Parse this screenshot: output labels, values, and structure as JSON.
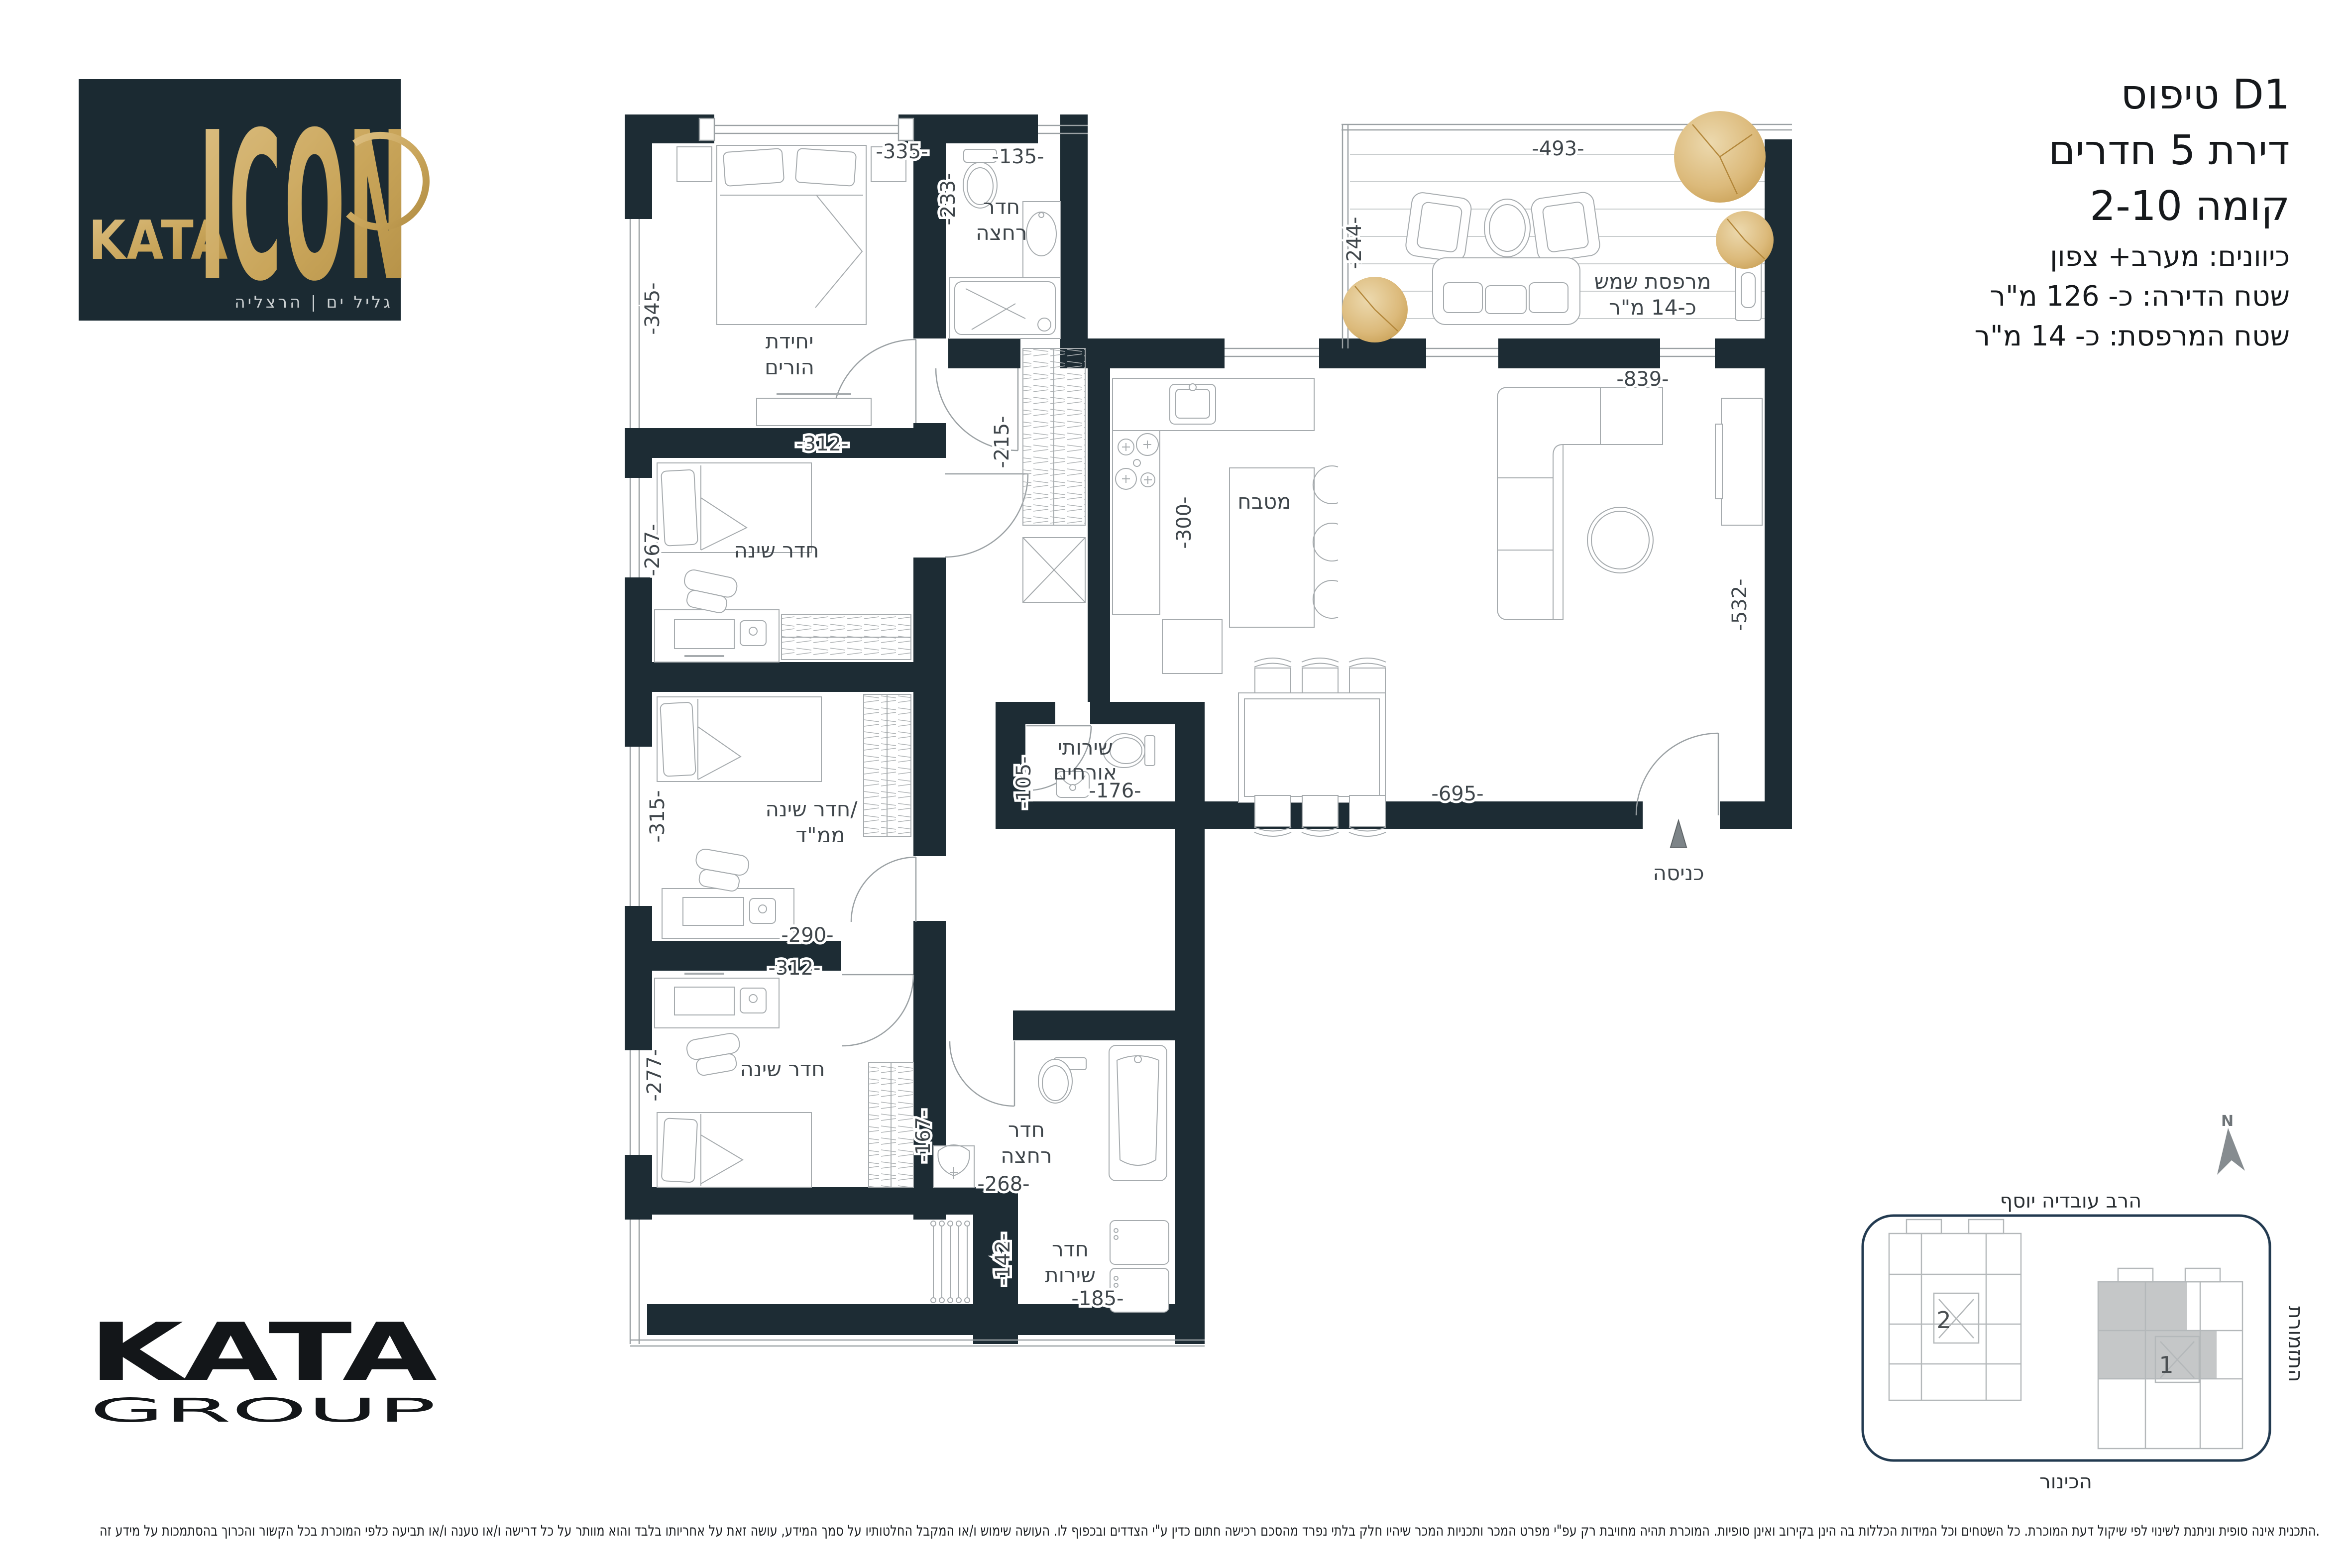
{
  "header": {
    "title_line1": "טיפוס D1",
    "title_line2": "דירת 5 חדרים",
    "title_line3": "קומה 2-10",
    "info_line1": "כיוונים: מערב+ צפון",
    "info_line2": "שטח הדירה: כ- 126 מ\"ר",
    "info_line3": "שטח המרפסת: כ- 14 מ\"ר"
  },
  "brand": {
    "kata": "KATA",
    "icon": "ICON",
    "tagline": "גליל ים | הרצליה",
    "group_name": "KATA",
    "group_sub": "GROUP"
  },
  "rooms": {
    "master_l1": "יחידת",
    "master_l2": "הורים",
    "bath_top_l1": "חדר",
    "bath_top_l2": "רחצה",
    "bedroom2": "חדר שינה",
    "mamad_l1": "חדר שינה/",
    "mamad_l2": "ממ\"ד",
    "bedroom3": "חדר שינה",
    "guest_wc_l1": "שירותי",
    "guest_wc_l2": "אורחים",
    "kitchen": "מטבח",
    "balcony_l1": "מרפסת שמש",
    "balcony_l2": "כ-14 מ\"ר",
    "bath_bottom_l1": "חדר",
    "bath_bottom_l2": "רחצה",
    "service_l1": "חדר",
    "service_l2": "שירות",
    "entrance": "כניסה"
  },
  "dims": {
    "d335": "-335-",
    "d135": "-135-",
    "d233": "-233-",
    "d345": "-345-",
    "d493": "-493-",
    "d244": "-244-",
    "d839": "-839-",
    "d312a": "-312-",
    "d267": "-267-",
    "d215": "-215-",
    "d300": "-300-",
    "d532": "-532-",
    "d315": "-315-",
    "d290": "-290-",
    "d105": "-105-",
    "d176": "-176-",
    "d695": "-695-",
    "d312b": "-312-",
    "d277": "-277-",
    "d167": "-167-",
    "d268": "-268-",
    "d142": "-142-",
    "d185": "-185-"
  },
  "siteplan": {
    "street_top": "הרב עובדיה יוסף",
    "street_right": "התזמורת",
    "street_bottom": "הכינור",
    "building_1": "1",
    "building_2": "2",
    "north": "N"
  },
  "disclaimer": "התכנית אינה סופית וניתנת לשינוי לפי שיקול דעת המוכרת. כל השטחים וכל המידות הכללות בה הינן בקירוב ואינן סופיות. המוכרת תהיה מחויבת רק עפ\"י מפרט המכר ותכניות המכר שיהיו חלק בלתי נפרד מהסכם רכישה חתום כדין ע\"י הצדדים ובכפוף לו. העושה שימוש ו/או המקבל החלטותיו על סמך המידע, עושה זאת על אחריותו בלבד והוא מוותר על כל דרישה ו/או טענה ו/או תביעה כלפי המוכרת בכל הקשור והכרוך בהסתמכות על מידע זה.",
  "colors": {
    "wall": "#1d2c34",
    "brand_gold": "#c9a55a",
    "logo_bg": "#1b2a32",
    "siteplan_border": "#223a50",
    "highlight_gray": "#c5c7c8"
  }
}
